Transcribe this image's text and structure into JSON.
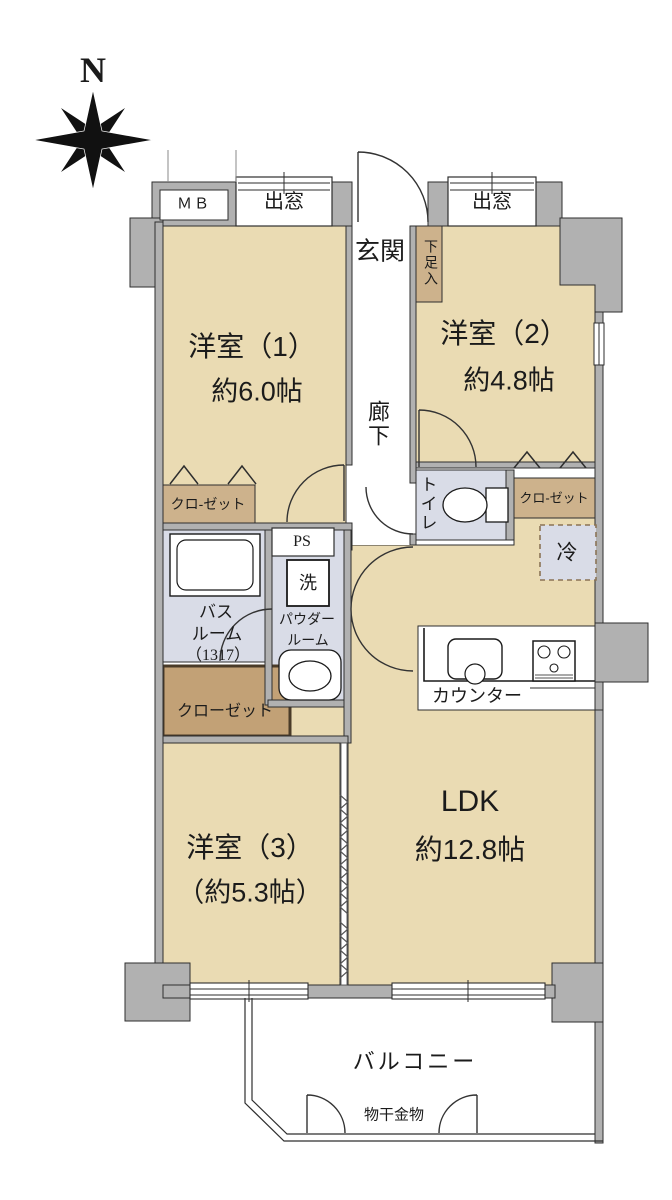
{
  "compass": {
    "north_label": "N"
  },
  "window_labels": {
    "bay_left": "出窓",
    "bay_right": "出窓"
  },
  "boxes": {
    "mb": "ＭＢ",
    "ps": "PS",
    "wash": "洗",
    "fridge": "冷",
    "shoe_cabinet": "下足入"
  },
  "rooms": {
    "western1": {
      "name": "洋室（1）",
      "area": "約6.0帖"
    },
    "western2": {
      "name": "洋室（2）",
      "area": "約4.8帖"
    },
    "western3": {
      "name": "洋室（3）",
      "area": "（約5.3帖）"
    },
    "ldk": {
      "name": "LDK",
      "area": "約12.8帖"
    },
    "entrance": "玄関",
    "hallway": "廊下",
    "toilet": "トイレ",
    "bathroom": {
      "line1": "バス",
      "line2": "ルーム",
      "line3": "（1317）"
    },
    "powder": {
      "line1": "パウダー",
      "line2": "ルーム"
    }
  },
  "storage": {
    "closet_left": "クロ-ゼット",
    "closet_right": "クロ-ゼット",
    "closet_bottom": "クローゼット"
  },
  "kitchen": {
    "counter": "カウンター"
  },
  "balcony": {
    "name": "バルコニー",
    "hardware": "物干金物"
  },
  "colors": {
    "room_beige": "#EADBB3",
    "wet_area": "#D9DCE7",
    "closet_tan": "#CDB28C",
    "closet_dark": "#C2A176",
    "wall_gray": "#B1B1B1",
    "line": "#2E2E2E"
  }
}
